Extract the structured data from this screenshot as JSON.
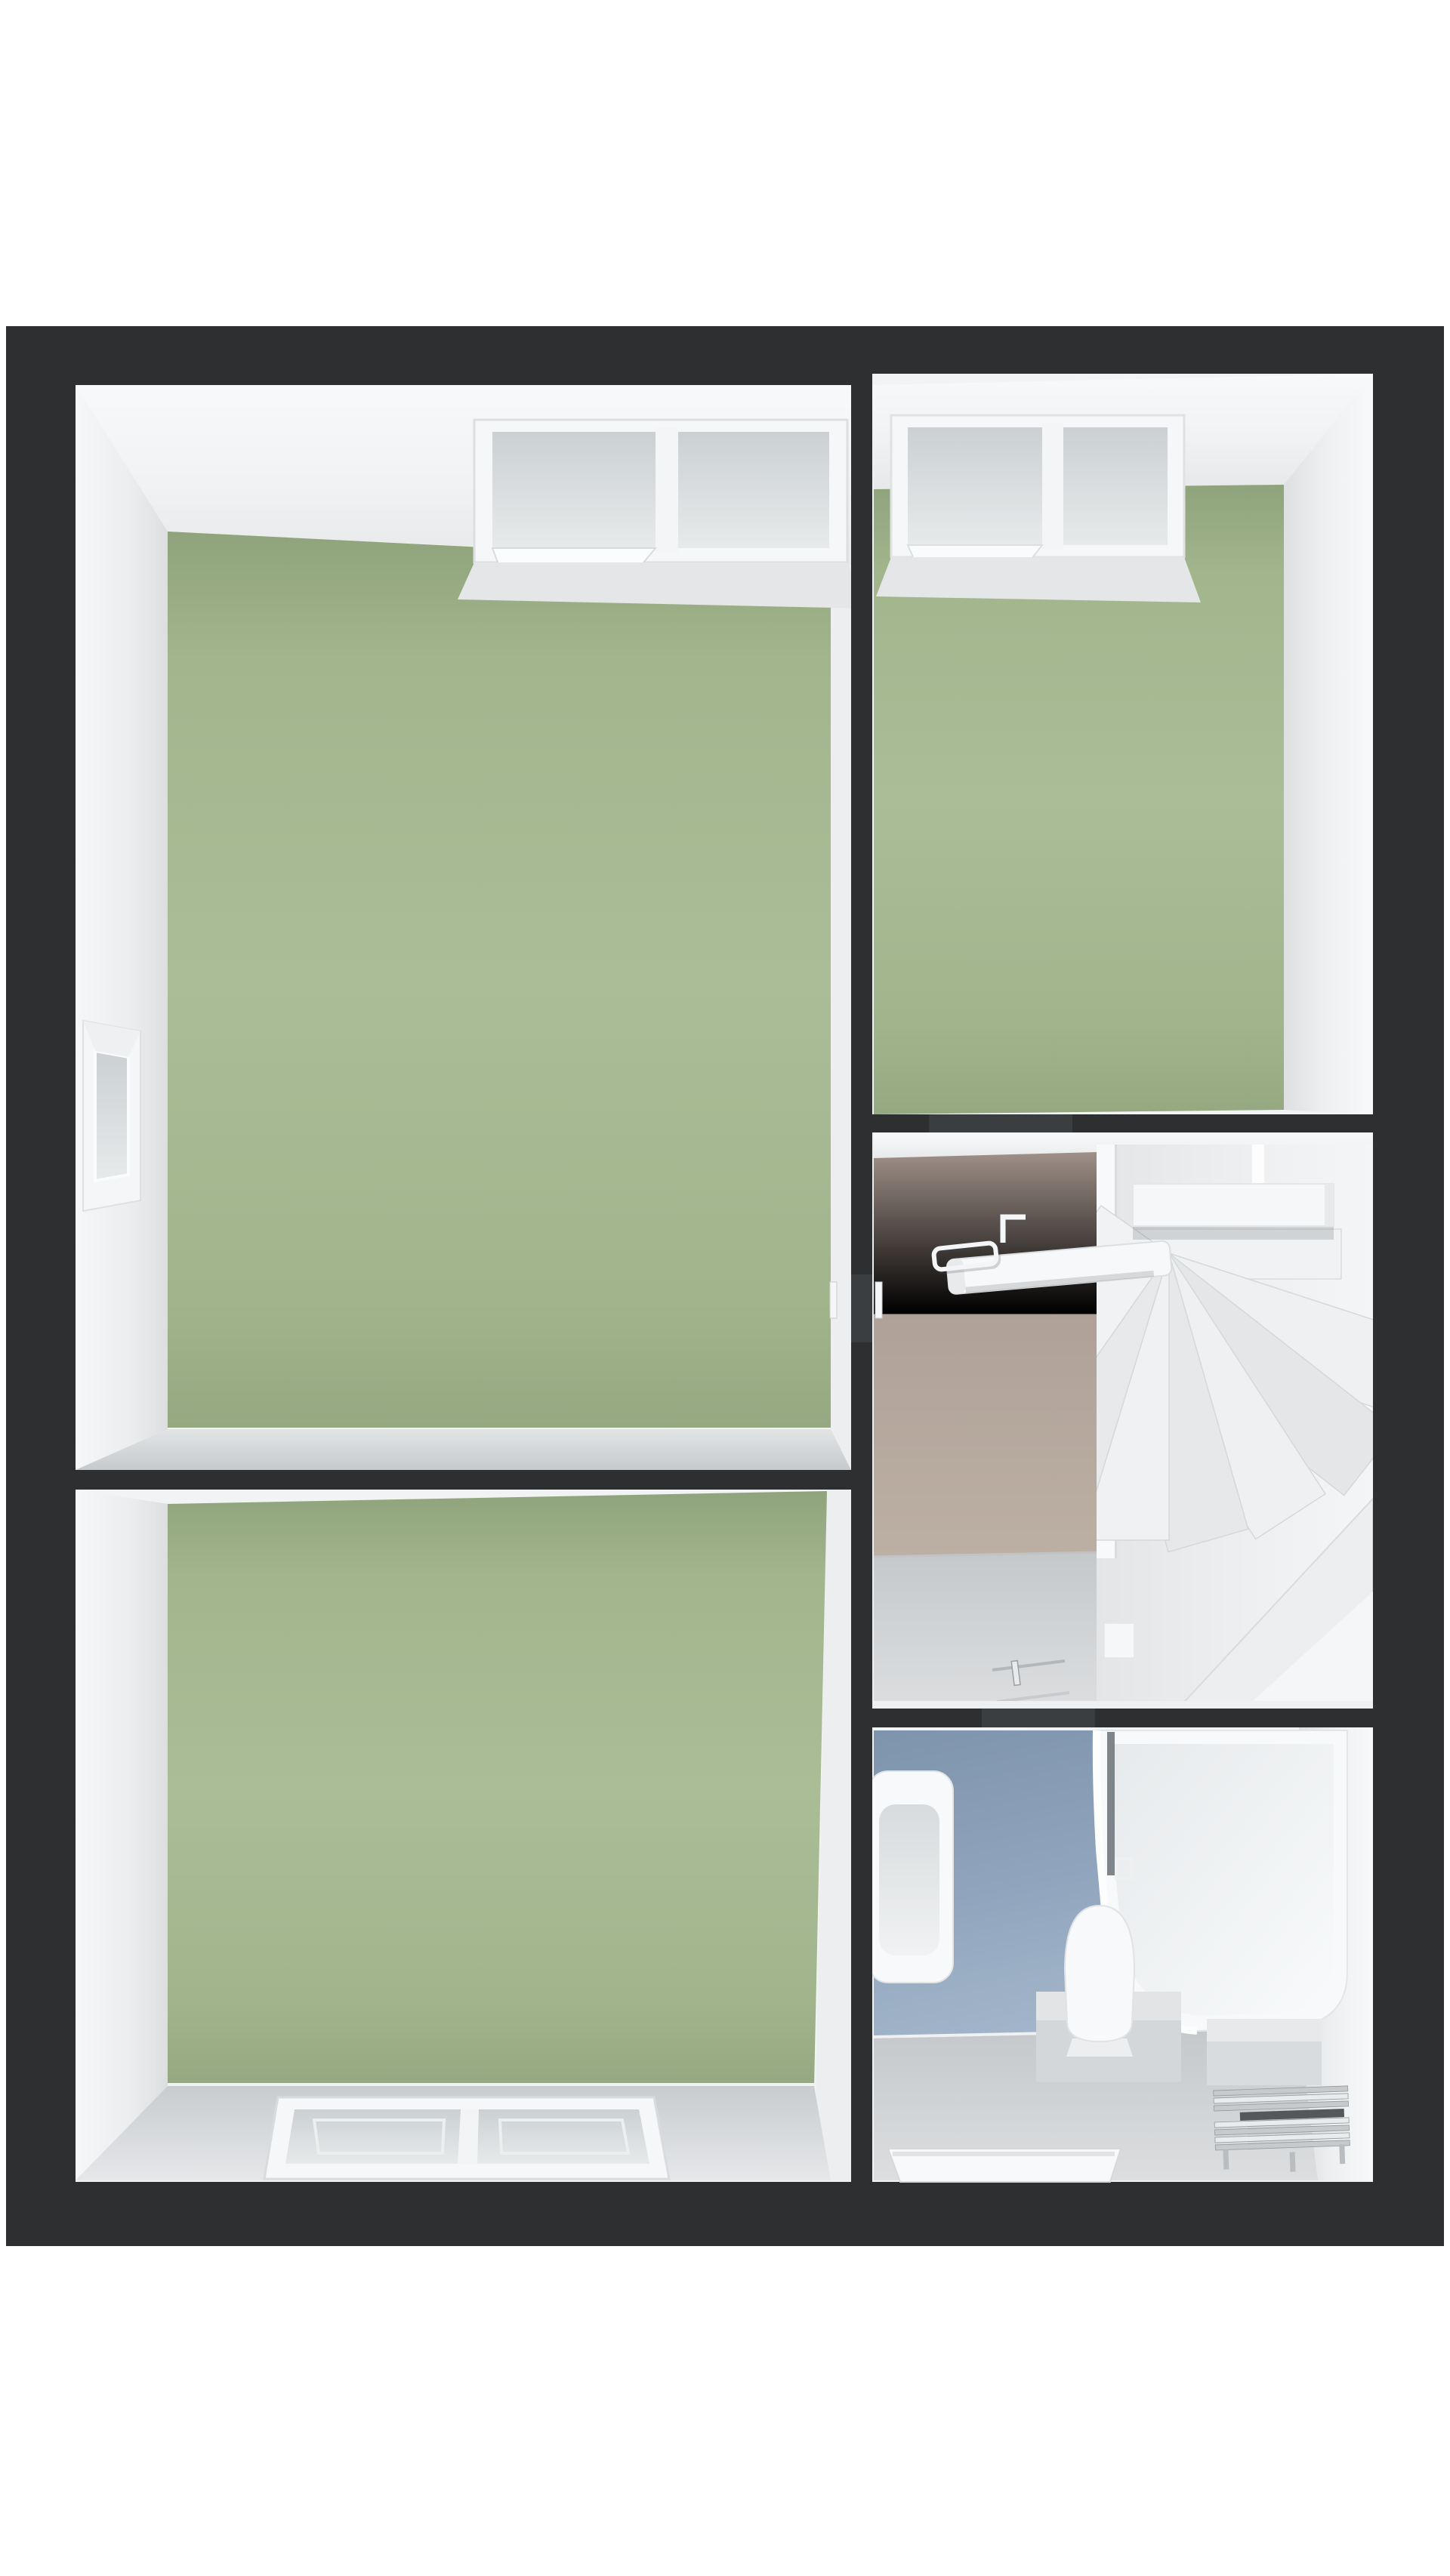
{
  "scene": {
    "kind": "3d-dollhouse-floor-plan-render",
    "background": "#ffffff",
    "floor_shown": "upper-floor"
  },
  "palette": {
    "page_bg": "#ffffff",
    "wall_cut": "#2d2f31",
    "wall_cut_door": "#3b3e41",
    "wall_face_light": "#f2f3f4",
    "wall_face_shade": "#e0e2e4",
    "sliver_white": "#eceef0",
    "floor_green_mid": "#a9bb96",
    "floor_green_deep": "#8fa37c",
    "floor_tan_mid": "#b3a598",
    "floor_blue_mid": "#8da2ba",
    "floor_gray_mid": "#cfd2d4",
    "stair_white": "#eef0f1",
    "glass_gray": "#d3d7d9",
    "fixture_white": "#f8f9fa",
    "chrome_light": "#e9ebec",
    "chrome_mid": "#c6cacc",
    "chrome_dark": "#94999c",
    "towel_bar_dark": "#55585a",
    "shadow_soft": "rgba(45,50,55,0.16)"
  },
  "plan": {
    "outer_walls": "thick dark cut walls",
    "rooms": [
      {
        "id": "room-top-left",
        "floor_color_key": "floor_green_mid",
        "openings": [
          "north-window-double",
          "west-window-recess",
          "door-to-landing"
        ]
      },
      {
        "id": "room-top-right",
        "floor_color_key": "floor_green_mid",
        "openings": [
          "north-window-double",
          "door-to-landing"
        ]
      },
      {
        "id": "room-bottom-left",
        "floor_color_key": "floor_green_mid",
        "openings": [
          "south-window-recess"
        ]
      },
      {
        "id": "landing",
        "floor_color_key": "floor_tan_mid",
        "features": [
          "winder-staircase",
          "handrail",
          "balustrade-beam",
          "door-handles",
          "threshold-to-bathroom"
        ]
      },
      {
        "id": "bathroom",
        "floor_color_key": "floor_blue_mid",
        "fixtures": [
          "washbasin-two-taps",
          "toilet",
          "bathtub",
          "shower-screen",
          "step-platforms",
          "towel-radiator-chrome",
          "mat-well"
        ]
      }
    ]
  }
}
